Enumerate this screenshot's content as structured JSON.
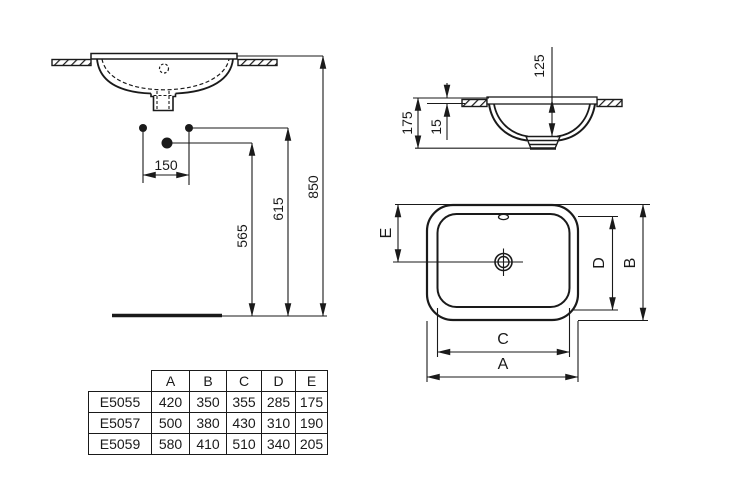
{
  "drawing": {
    "front_view": {
      "dim_150": "150",
      "dim_565": "565",
      "dim_615": "615",
      "dim_850": "850"
    },
    "side_view": {
      "dim_125": "125",
      "dim_175": "175",
      "dim_15": "15"
    },
    "plan_view": {
      "dim_a": "A",
      "dim_b": "B",
      "dim_c": "C",
      "dim_d": "D",
      "dim_e": "E"
    }
  },
  "table": {
    "columns": [
      "A",
      "B",
      "C",
      "D",
      "E"
    ],
    "rows": [
      {
        "model": "E5055",
        "values": [
          "420",
          "350",
          "355",
          "285",
          "175"
        ]
      },
      {
        "model": "E5057",
        "values": [
          "500",
          "380",
          "430",
          "310",
          "190"
        ]
      },
      {
        "model": "E5059",
        "values": [
          "580",
          "410",
          "510",
          "340",
          "205"
        ]
      }
    ]
  },
  "colors": {
    "line": "#1a1a1a",
    "background": "#ffffff"
  }
}
